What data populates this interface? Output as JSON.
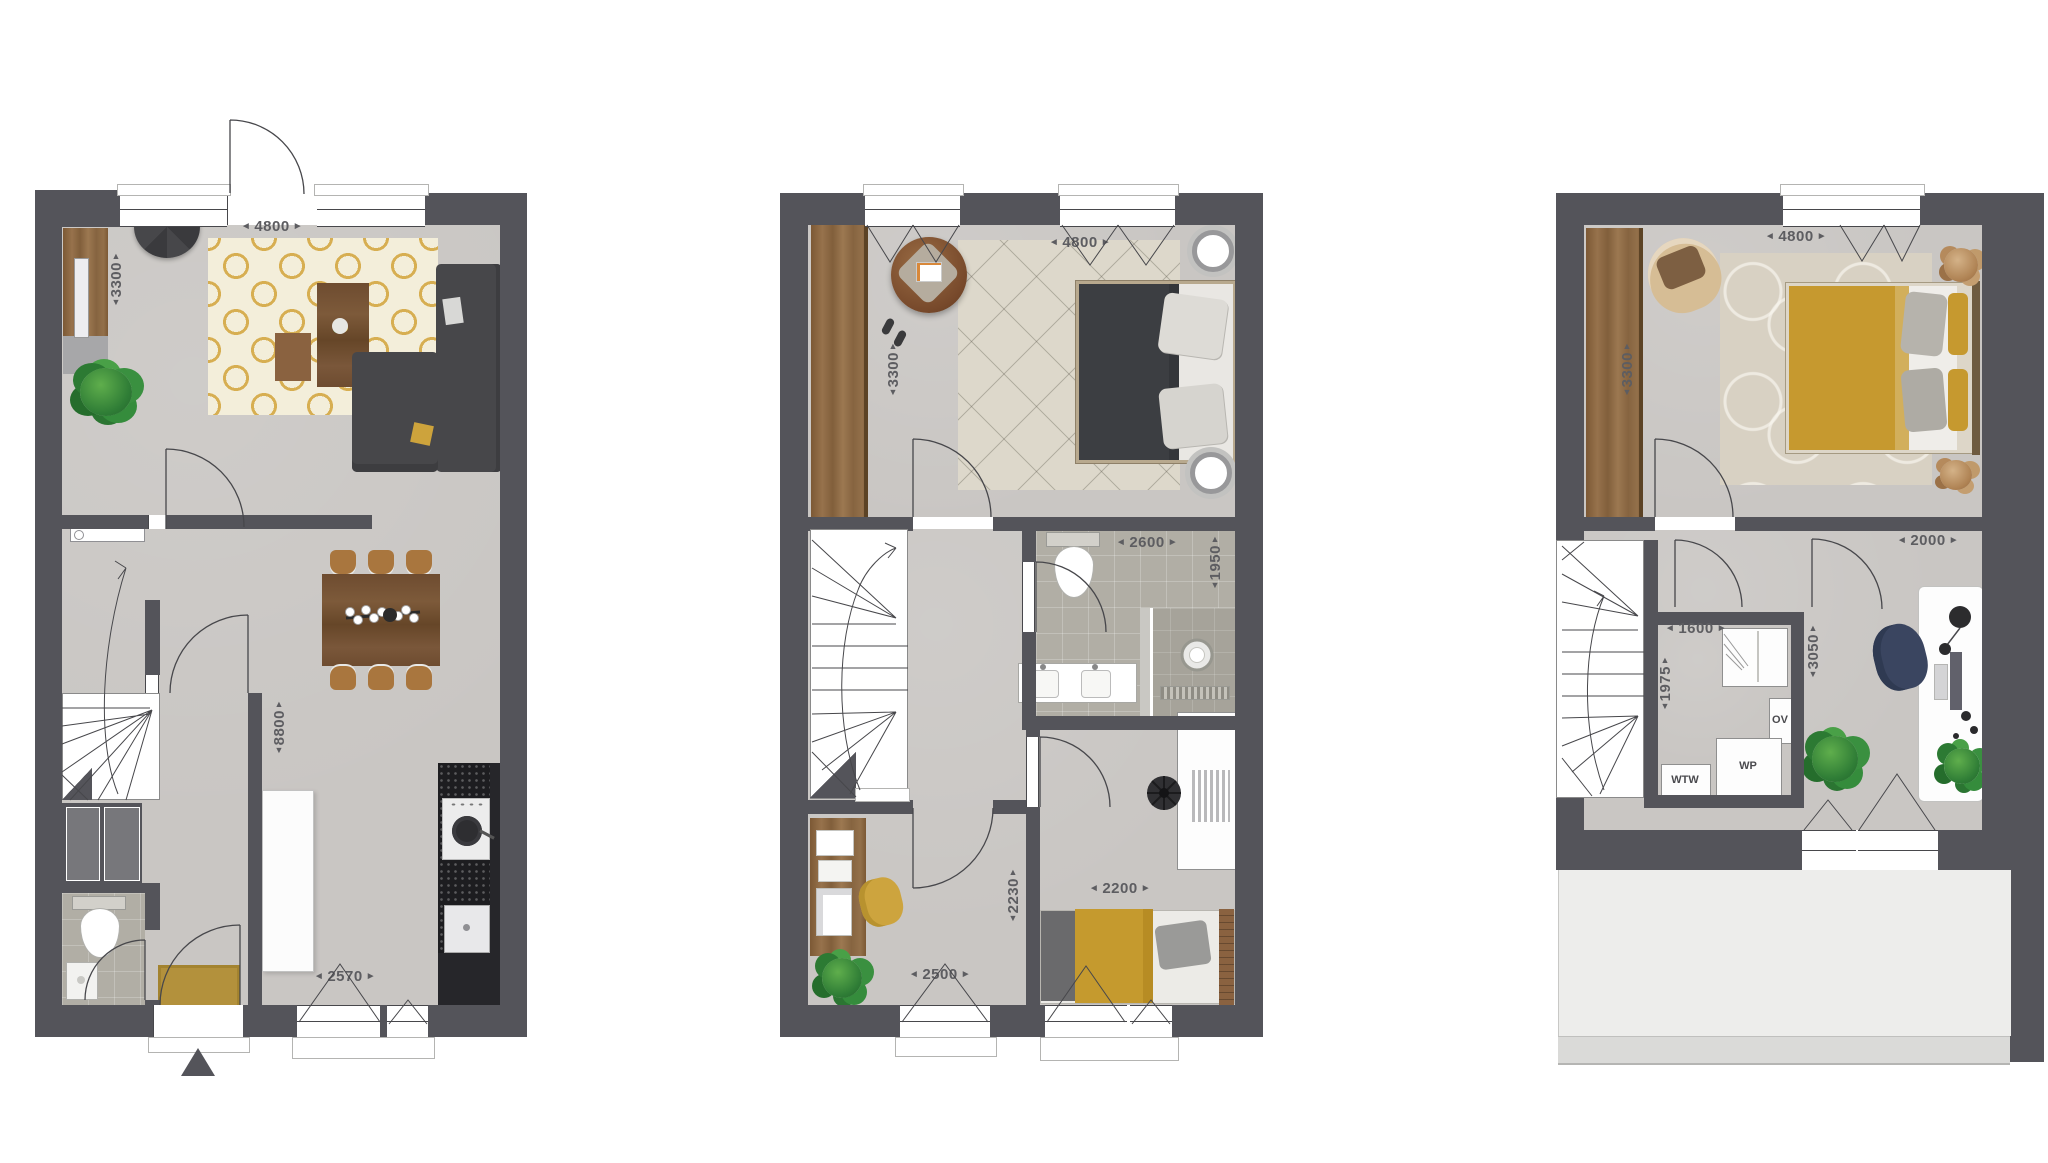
{
  "glyphs": {
    "left": "◄",
    "right": "►",
    "up": "▲",
    "down": "▼"
  },
  "colors": {
    "wall": "#54545A",
    "floor": "#C9C6C3",
    "tile": "#B1AEA5",
    "accent_gold": "#C79A30",
    "wood": "#8A6134",
    "linework": "#47474B"
  },
  "ground_floor": {
    "width_top": "4800",
    "living_depth": "3300",
    "total_depth": "8800",
    "kitchen_width": "2570"
  },
  "first_floor": {
    "width_top": "4800",
    "bedroom_depth": "3300",
    "bathroom_width": "2600",
    "bathroom_depth": "1950",
    "hall_depth": "2230",
    "bedroom2_width": "2200",
    "study_width": "2500"
  },
  "second_floor": {
    "width_top": "4800",
    "bedroom_depth": "3300",
    "workspace_width": "2000",
    "tech_width": "1600",
    "tech_depth": "1975",
    "workspace_depth": "3050",
    "appliances": {
      "ov": "OV",
      "wtw": "WTW",
      "wp": "WP"
    }
  }
}
